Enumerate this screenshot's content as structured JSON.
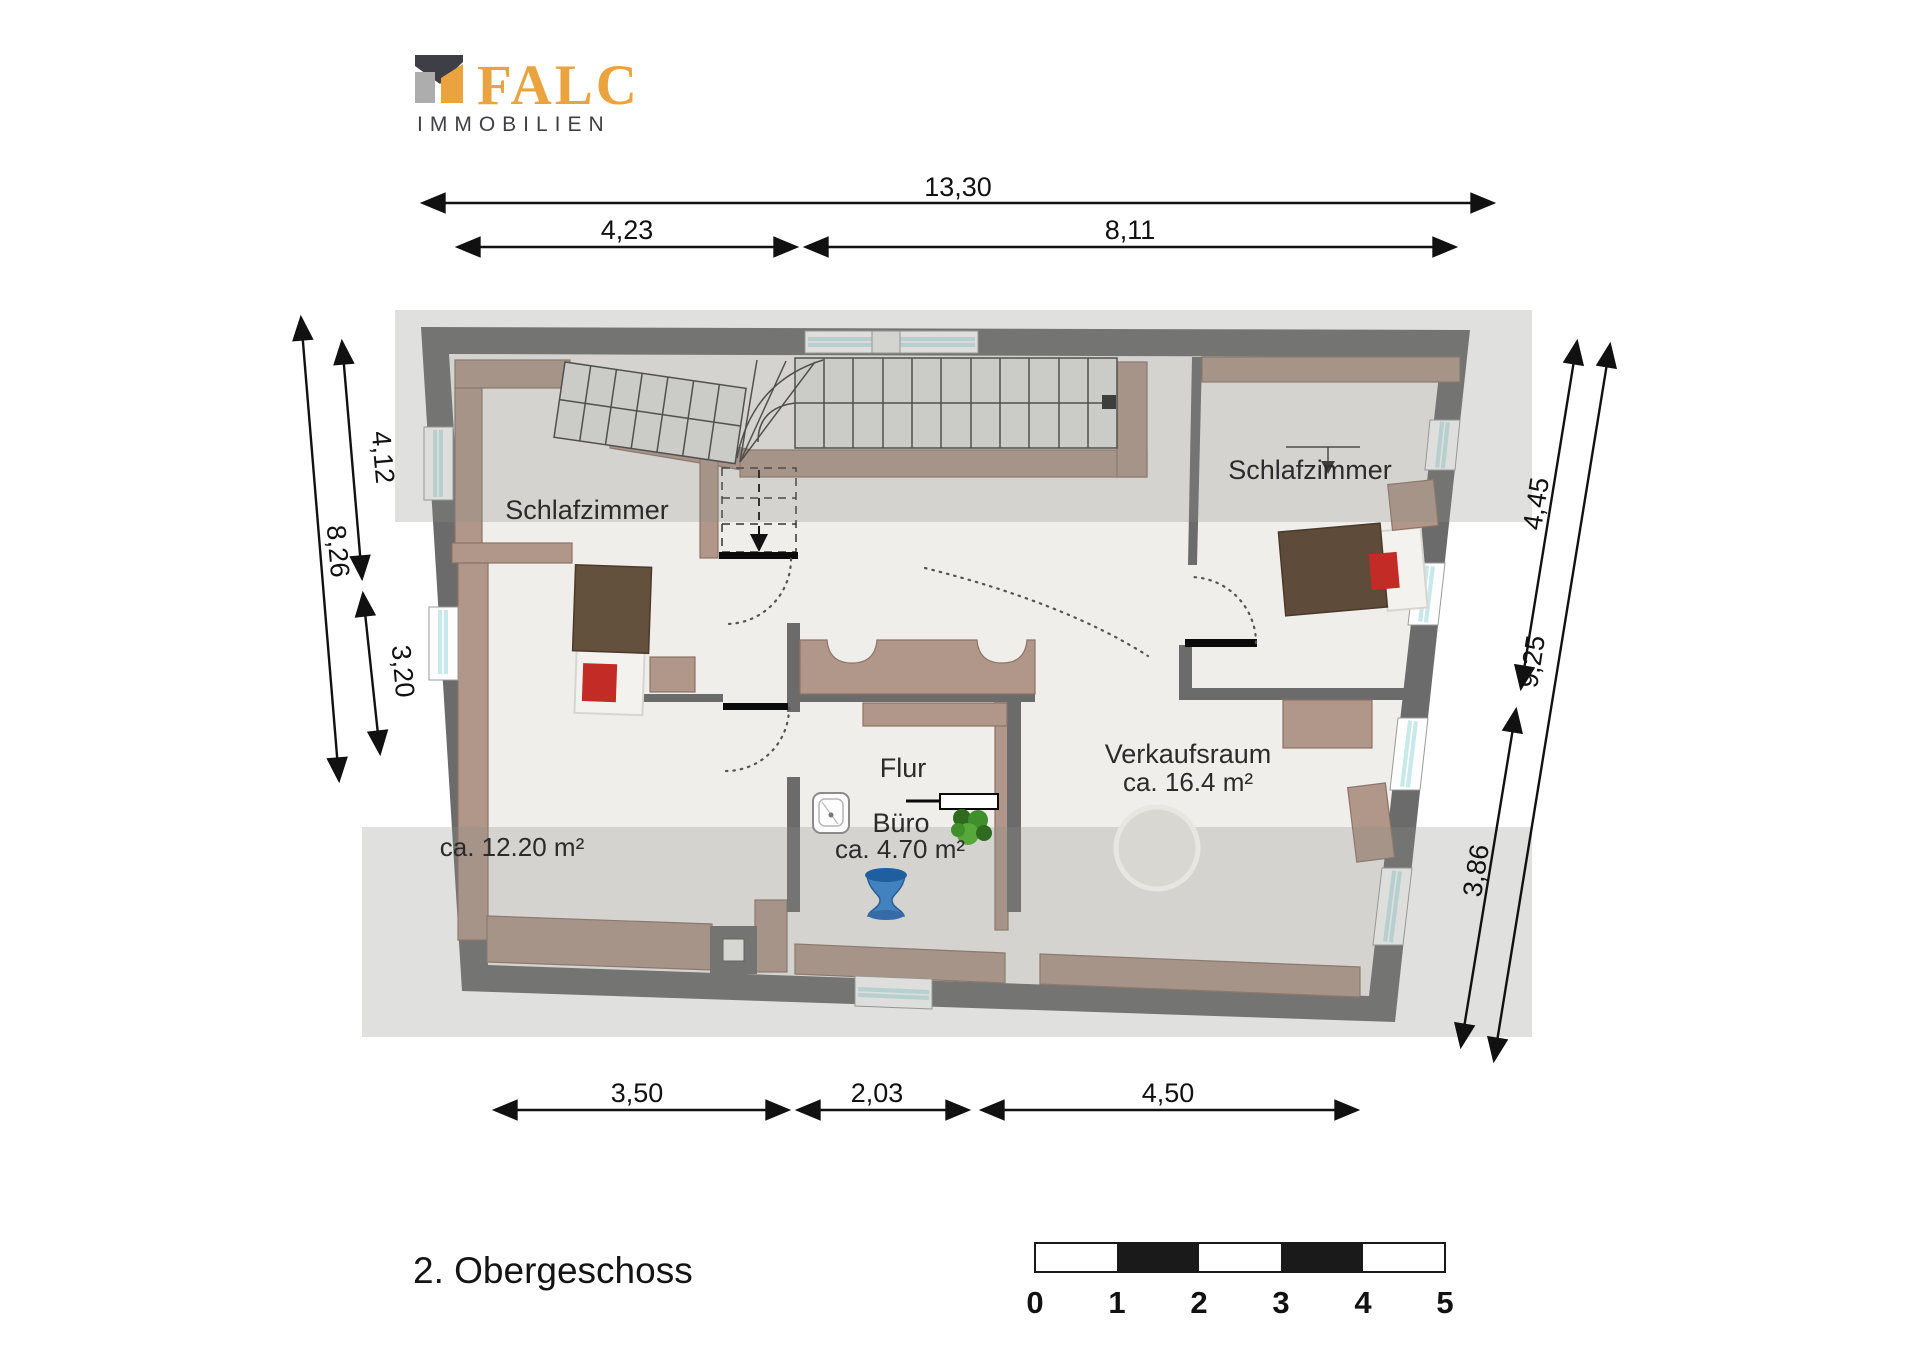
{
  "brand": {
    "name": "FALC",
    "subtitle": "IMMOBILIEN"
  },
  "title": "2. Obergeschoss",
  "plan": {
    "rooms": [
      {
        "name": "Schlafzimmer"
      },
      {
        "name": "Schlafzimmer"
      },
      {
        "name": "Flur"
      },
      {
        "name": "Büro",
        "area": "ca. 4.70 m²"
      },
      {
        "name": "Verkaufsraum",
        "area": "ca. 16.4 m²"
      },
      {
        "area": "ca. 12.20 m²"
      }
    ]
  },
  "dimensions": {
    "top_total": "13,30",
    "top_left": "4,23",
    "top_right": "8,11",
    "left_upper": "4,12",
    "left_total": "8,26",
    "left_lower": "3,20",
    "right_upper": "4,45",
    "right_total": "9,25",
    "right_lower": "3,86",
    "bottom_left": "3,50",
    "bottom_mid": "2,03",
    "bottom_right": "4,50"
  },
  "scale_bar": {
    "ticks": [
      "0",
      "1",
      "2",
      "3",
      "4",
      "5"
    ]
  },
  "colors": {
    "accent_orange": "#EBA33F",
    "logo_dark": "#3E3E46",
    "logo_gray": "#ADADAD",
    "wall_gray": "#6B6B6B",
    "wood_tan": "#B1978A",
    "floor": "#EFEEEA",
    "window_glass": "#C9E8EA",
    "roof_overlay_gray": "#8C8C88",
    "bed_brown": "#5F4B3A",
    "accent_red": "#C32B26",
    "plant_green": "#3F8F2A",
    "vase_blue": "#4283BF"
  }
}
